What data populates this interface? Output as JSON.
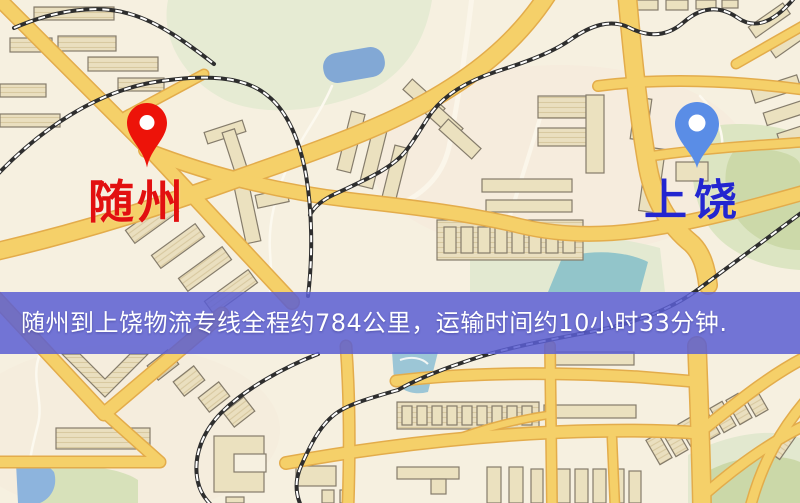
{
  "map": {
    "origin": {
      "label": "随州",
      "pin_color": "#ed1309",
      "label_color": "#e21010"
    },
    "destination": {
      "label": "上饶",
      "pin_color": "#5a8de6",
      "label_color": "#2326d0"
    },
    "banner": {
      "text": "随州到上饶物流专线全程约784公里，运输时间约10小时33分钟.",
      "bg_color": "rgba(90,94,210,0.85)",
      "text_color": "#ffffff",
      "distance": "约784公里",
      "duration": "约10小时33分钟"
    },
    "palette": {
      "background": "#f6f0e0",
      "road": "#f5d069",
      "road_casing": "#e3ac4b",
      "building": "#ebe1bf",
      "building_outline": "#857c6b",
      "green_area": "#e2e9d0",
      "water": "#82a8d5",
      "railway": "#2e2e2e"
    }
  }
}
